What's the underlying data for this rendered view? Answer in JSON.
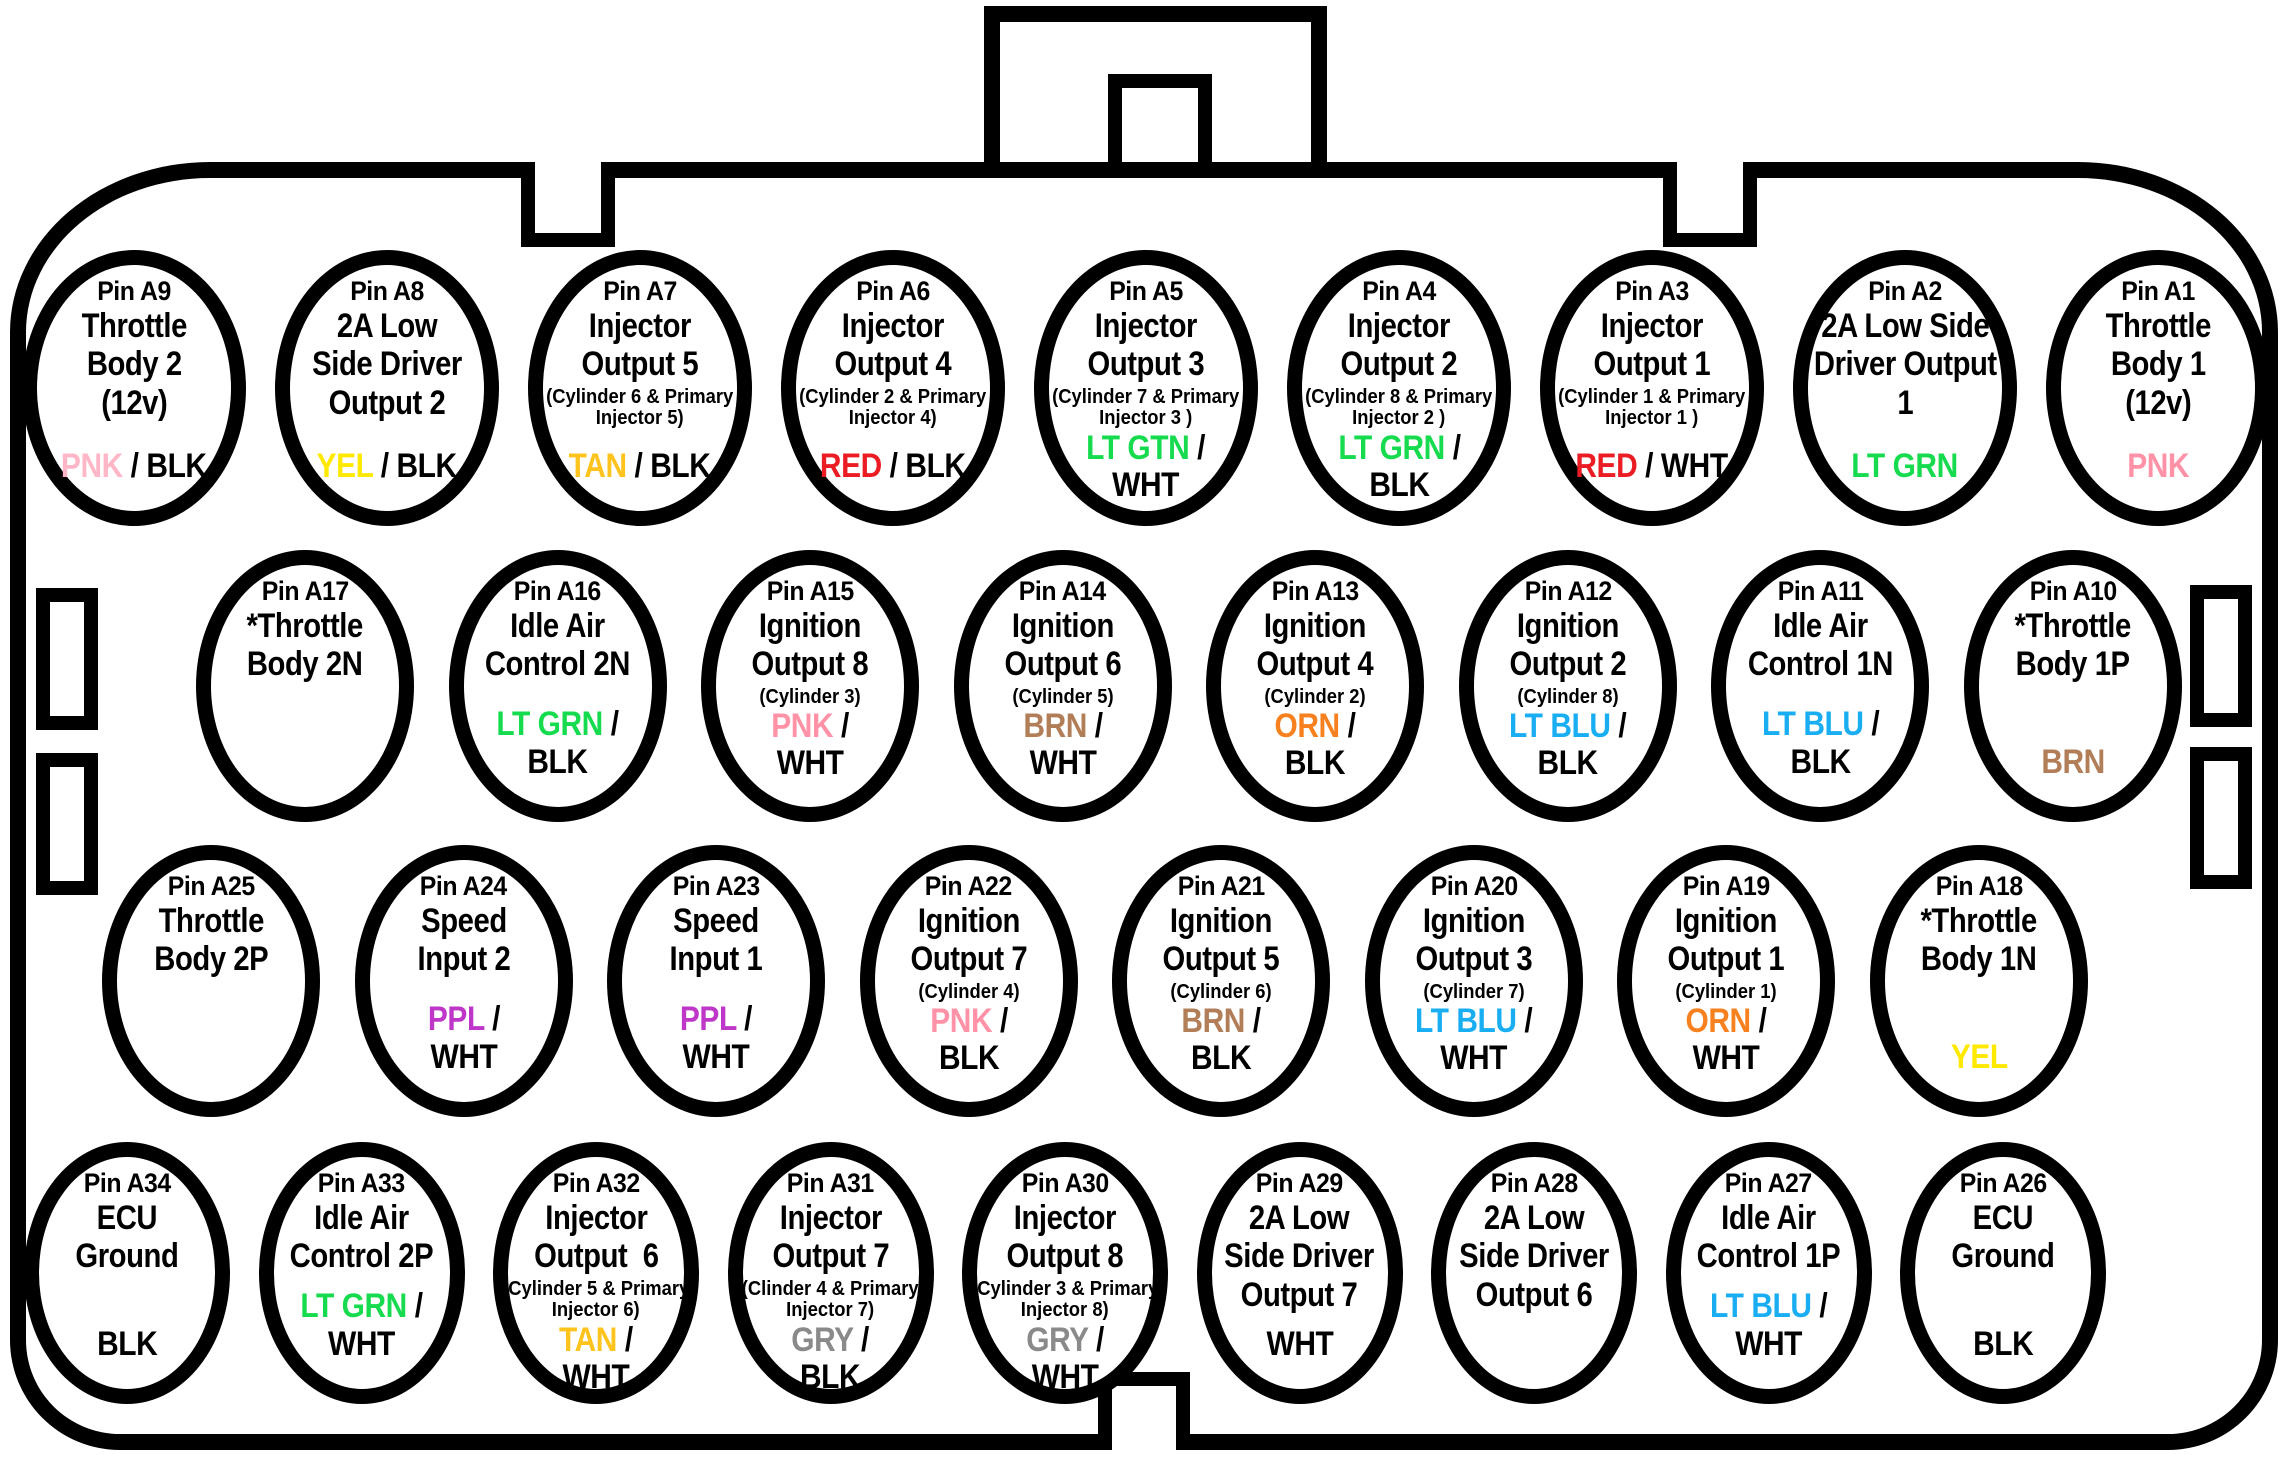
{
  "palette": {
    "pnk_light": "#FFB7C7",
    "pnk": "#FF92A6",
    "yel": "#FFE900",
    "tan": "#FFC31E",
    "red": "#EC1C24",
    "lt_grn": "#16DB4E",
    "brn": "#B27E58",
    "orn": "#F8811F",
    "lt_blu": "#19ADF2",
    "ppl": "#BE37C8",
    "gry": "#8A8A8A",
    "blk": "#000000"
  },
  "connector": {
    "outline": "#000000",
    "fill": "#FFFFFF"
  },
  "rows": [
    {
      "pins": [
        {
          "id": "Pin A9",
          "label": "Throttle\nBody 2\n(12v)",
          "wire": [
            [
              {
                "t": "PNK",
                "c": "pnk_light"
              },
              {
                "t": " / BLK",
                "c": "blk"
              }
            ]
          ]
        },
        {
          "id": "Pin A8",
          "label": "2A Low\nSide Driver\nOutput 2",
          "wire": [
            [
              {
                "t": "YEL",
                "c": "yel"
              },
              {
                "t": " / BLK",
                "c": "blk"
              }
            ]
          ]
        },
        {
          "id": "Pin A7",
          "label": "Injector\nOutput 5",
          "sub": "(Cylinder 6 & Primary\nInjector 5)",
          "wire": [
            [
              {
                "t": "TAN",
                "c": "tan"
              },
              {
                "t": " / BLK",
                "c": "blk"
              }
            ]
          ]
        },
        {
          "id": "Pin A6",
          "label": "Injector\nOutput 4",
          "sub": "(Cylinder 2 & Primary\nInjector 4)",
          "wire": [
            [
              {
                "t": "RED",
                "c": "red"
              },
              {
                "t": " / BLK",
                "c": "blk"
              }
            ]
          ]
        },
        {
          "id": "Pin A5",
          "label": "Injector\nOutput 3",
          "sub": "(Cylinder 7 & Primary\nInjector 3 )",
          "wire": [
            [
              {
                "t": "LT GTN",
                "c": "lt_grn"
              },
              {
                "t": " /",
                "c": "blk"
              }
            ],
            [
              {
                "t": "WHT",
                "c": "blk"
              }
            ]
          ]
        },
        {
          "id": "Pin A4",
          "label": "Injector\nOutput 2",
          "sub": "(Cylinder 8 & Primary\nInjector 2 )",
          "wire": [
            [
              {
                "t": "LT GRN",
                "c": "lt_grn"
              },
              {
                "t": " /",
                "c": "blk"
              }
            ],
            [
              {
                "t": "BLK",
                "c": "blk"
              }
            ]
          ]
        },
        {
          "id": "Pin A3",
          "label": "Injector\nOutput 1",
          "sub": "(Cylinder 1 & Primary\nInjector 1 )",
          "wire": [
            [
              {
                "t": "RED",
                "c": "red"
              },
              {
                "t": " / WHT",
                "c": "blk"
              }
            ]
          ]
        },
        {
          "id": "Pin A2",
          "label": "2A Low Side\nDriver Output\n1",
          "wire": [
            [
              {
                "t": "LT GRN",
                "c": "lt_grn"
              }
            ]
          ]
        },
        {
          "id": "Pin A1",
          "label": "Throttle\nBody 1\n(12v)",
          "wire": [
            [
              {
                "t": "PNK",
                "c": "pnk"
              }
            ]
          ]
        }
      ]
    },
    {
      "pins": [
        {
          "id": "Pin A17",
          "label": "*Throttle\nBody 2N"
        },
        {
          "id": "Pin A16",
          "label": "Idle Air\nControl 2N",
          "wire": [
            [
              {
                "t": "LT GRN",
                "c": "lt_grn"
              },
              {
                "t": " /",
                "c": "blk"
              }
            ],
            [
              {
                "t": "BLK",
                "c": "blk"
              }
            ]
          ]
        },
        {
          "id": "Pin A15",
          "label": "Ignition\nOutput 8",
          "sub": "(Cylinder 3)",
          "wire": [
            [
              {
                "t": "PNK",
                "c": "pnk"
              },
              {
                "t": " /",
                "c": "blk"
              }
            ],
            [
              {
                "t": "WHT",
                "c": "blk"
              }
            ]
          ]
        },
        {
          "id": "Pin A14",
          "label": "Ignition\nOutput 6",
          "sub": "(Cylinder 5)",
          "wire": [
            [
              {
                "t": "BRN",
                "c": "brn"
              },
              {
                "t": " /",
                "c": "blk"
              }
            ],
            [
              {
                "t": "WHT",
                "c": "blk"
              }
            ]
          ]
        },
        {
          "id": "Pin A13",
          "label": "Ignition\nOutput 4",
          "sub": "(Cylinder 2)",
          "wire": [
            [
              {
                "t": "ORN",
                "c": "orn"
              },
              {
                "t": " /",
                "c": "blk"
              }
            ],
            [
              {
                "t": "BLK",
                "c": "blk"
              }
            ]
          ]
        },
        {
          "id": "Pin A12",
          "label": "Ignition\nOutput 2",
          "sub": "(Cylinder 8)",
          "wire": [
            [
              {
                "t": "LT BLU",
                "c": "lt_blu"
              },
              {
                "t": " /",
                "c": "blk"
              }
            ],
            [
              {
                "t": "BLK",
                "c": "blk"
              }
            ]
          ]
        },
        {
          "id": "Pin A11",
          "label": "Idle Air\nControl 1N",
          "wire": [
            [
              {
                "t": "LT BLU",
                "c": "lt_blu"
              },
              {
                "t": " /",
                "c": "blk"
              }
            ],
            [
              {
                "t": "BLK",
                "c": "blk"
              }
            ]
          ]
        },
        {
          "id": "Pin A10",
          "label": "*Throttle\nBody 1P",
          "wire": [
            [
              {
                "t": "BRN",
                "c": "brn"
              }
            ]
          ]
        }
      ]
    },
    {
      "pins": [
        {
          "id": "Pin A25",
          "label": "Throttle\nBody 2P"
        },
        {
          "id": "Pin A24",
          "label": "Speed\nInput 2",
          "wire": [
            [
              {
                "t": "PPL",
                "c": "ppl"
              },
              {
                "t": " /",
                "c": "blk"
              }
            ],
            [
              {
                "t": "WHT",
                "c": "blk"
              }
            ]
          ]
        },
        {
          "id": "Pin A23",
          "label": "Speed\nInput 1",
          "wire": [
            [
              {
                "t": "PPL",
                "c": "ppl"
              },
              {
                "t": " /",
                "c": "blk"
              }
            ],
            [
              {
                "t": "WHT",
                "c": "blk"
              }
            ]
          ]
        },
        {
          "id": "Pin A22",
          "label": "Ignition\nOutput 7",
          "sub": "(Cylinder 4)",
          "wire": [
            [
              {
                "t": "PNK",
                "c": "pnk"
              },
              {
                "t": " /",
                "c": "blk"
              }
            ],
            [
              {
                "t": "BLK",
                "c": "blk"
              }
            ]
          ]
        },
        {
          "id": "Pin A21",
          "label": "Ignition\nOutput 5",
          "sub": "(Cylinder 6)",
          "wire": [
            [
              {
                "t": "BRN",
                "c": "brn"
              },
              {
                "t": " /",
                "c": "blk"
              }
            ],
            [
              {
                "t": "BLK",
                "c": "blk"
              }
            ]
          ]
        },
        {
          "id": "Pin A20",
          "label": "Ignition\nOutput 3",
          "sub": "(Cylinder 7)",
          "wire": [
            [
              {
                "t": "LT BLU",
                "c": "lt_blu"
              },
              {
                "t": " /",
                "c": "blk"
              }
            ],
            [
              {
                "t": "WHT",
                "c": "blk"
              }
            ]
          ]
        },
        {
          "id": "Pin A19",
          "label": "Ignition\nOutput 1",
          "sub": "(Cylinder 1)",
          "wire": [
            [
              {
                "t": "ORN",
                "c": "orn"
              },
              {
                "t": " /",
                "c": "blk"
              }
            ],
            [
              {
                "t": "WHT",
                "c": "blk"
              }
            ]
          ]
        },
        {
          "id": "Pin A18",
          "label": "*Throttle\nBody 1N",
          "wire": [
            [
              {
                "t": "YEL",
                "c": "yel"
              }
            ]
          ]
        }
      ]
    },
    {
      "pins": [
        {
          "id": "Pin A34",
          "label": "ECU\nGround",
          "wire": [
            [
              {
                "t": "BLK",
                "c": "blk"
              }
            ]
          ]
        },
        {
          "id": "Pin A33",
          "label": "Idle Air\nControl 2P",
          "wire": [
            [
              {
                "t": "LT GRN",
                "c": "lt_grn"
              },
              {
                "t": " /",
                "c": "blk"
              }
            ],
            [
              {
                "t": "WHT",
                "c": "blk"
              }
            ]
          ]
        },
        {
          "id": "Pin A32",
          "label": "Injector\nOutput  6",
          "sub": "(Cylinder 5 & Primary\nInjector 6)",
          "wire": [
            [
              {
                "t": "TAN",
                "c": "tan"
              },
              {
                "t": " /",
                "c": "blk"
              }
            ],
            [
              {
                "t": "WHT",
                "c": "blk"
              }
            ]
          ]
        },
        {
          "id": "Pin A31",
          "label": "Injector\nOutput 7",
          "sub": "(Clinder 4 & Primary\nInjector 7)",
          "wire": [
            [
              {
                "t": "GRY",
                "c": "gry"
              },
              {
                "t": " /",
                "c": "blk"
              }
            ],
            [
              {
                "t": "BLK",
                "c": "blk"
              }
            ]
          ]
        },
        {
          "id": "Pin A30",
          "label": "Injector\nOutput 8",
          "sub": "(Cylinder 3 & Primary\nInjector 8)",
          "wire": [
            [
              {
                "t": "GRY",
                "c": "gry"
              },
              {
                "t": " /",
                "c": "blk"
              }
            ],
            [
              {
                "t": "WHT",
                "c": "blk"
              }
            ]
          ]
        },
        {
          "id": "Pin A29",
          "label": "2A Low\nSide Driver\nOutput 7",
          "wire": [
            [
              {
                "t": "WHT",
                "c": "blk"
              }
            ]
          ]
        },
        {
          "id": "Pin A28",
          "label": "2A Low\nSide Driver\nOutput 6"
        },
        {
          "id": "Pin A27",
          "label": "Idle Air\nControl 1P",
          "wire": [
            [
              {
                "t": "LT BLU",
                "c": "lt_blu"
              },
              {
                "t": " /",
                "c": "blk"
              }
            ],
            [
              {
                "t": "WHT",
                "c": "blk"
              }
            ]
          ]
        },
        {
          "id": "Pin A26",
          "label": "ECU\nGround",
          "wire": [
            [
              {
                "t": "BLK",
                "c": "blk"
              }
            ]
          ]
        }
      ]
    }
  ]
}
